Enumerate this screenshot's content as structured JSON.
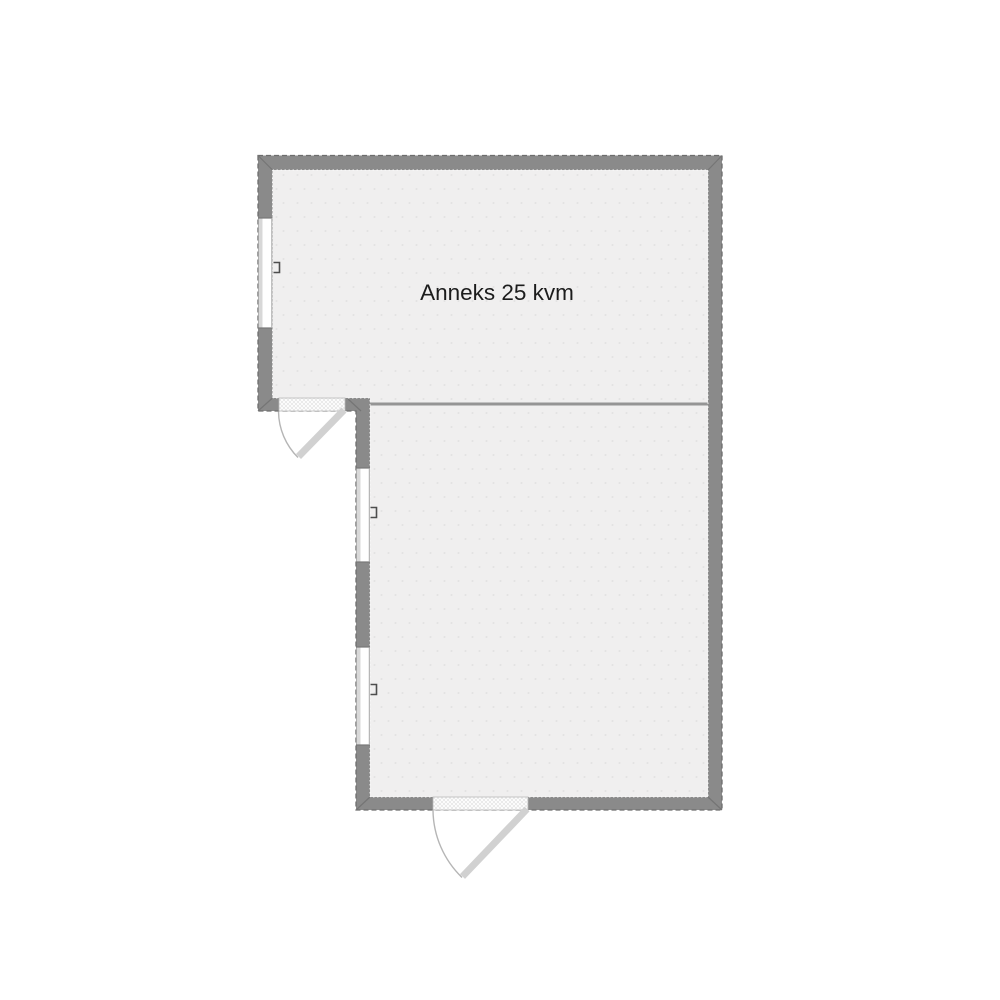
{
  "floorplan": {
    "rooms": [
      {
        "id": "anneks",
        "label": "Anneks 25 kvm"
      },
      {
        "id": "lower-room",
        "label": ""
      }
    ],
    "window_count": 3,
    "door_count": 2,
    "colors": {
      "background": "#ffffff",
      "wall": "#8a8a8a",
      "wall_outline": "#6d6d6d",
      "miter_line": "#757575",
      "floor": "#f0efef",
      "floor_dot": "#e2e2e2",
      "divider": "#959595",
      "window_glass": "#ffffff",
      "window_sill": "#d8d8d8",
      "window_frame": "#787878",
      "latch": "#4d4d4d",
      "door_opening_border": "#b8b8b8",
      "door_leaf": "#d1d1d1",
      "door_arc": "#b5b5b5",
      "label_text": "#1c1c1c"
    }
  }
}
